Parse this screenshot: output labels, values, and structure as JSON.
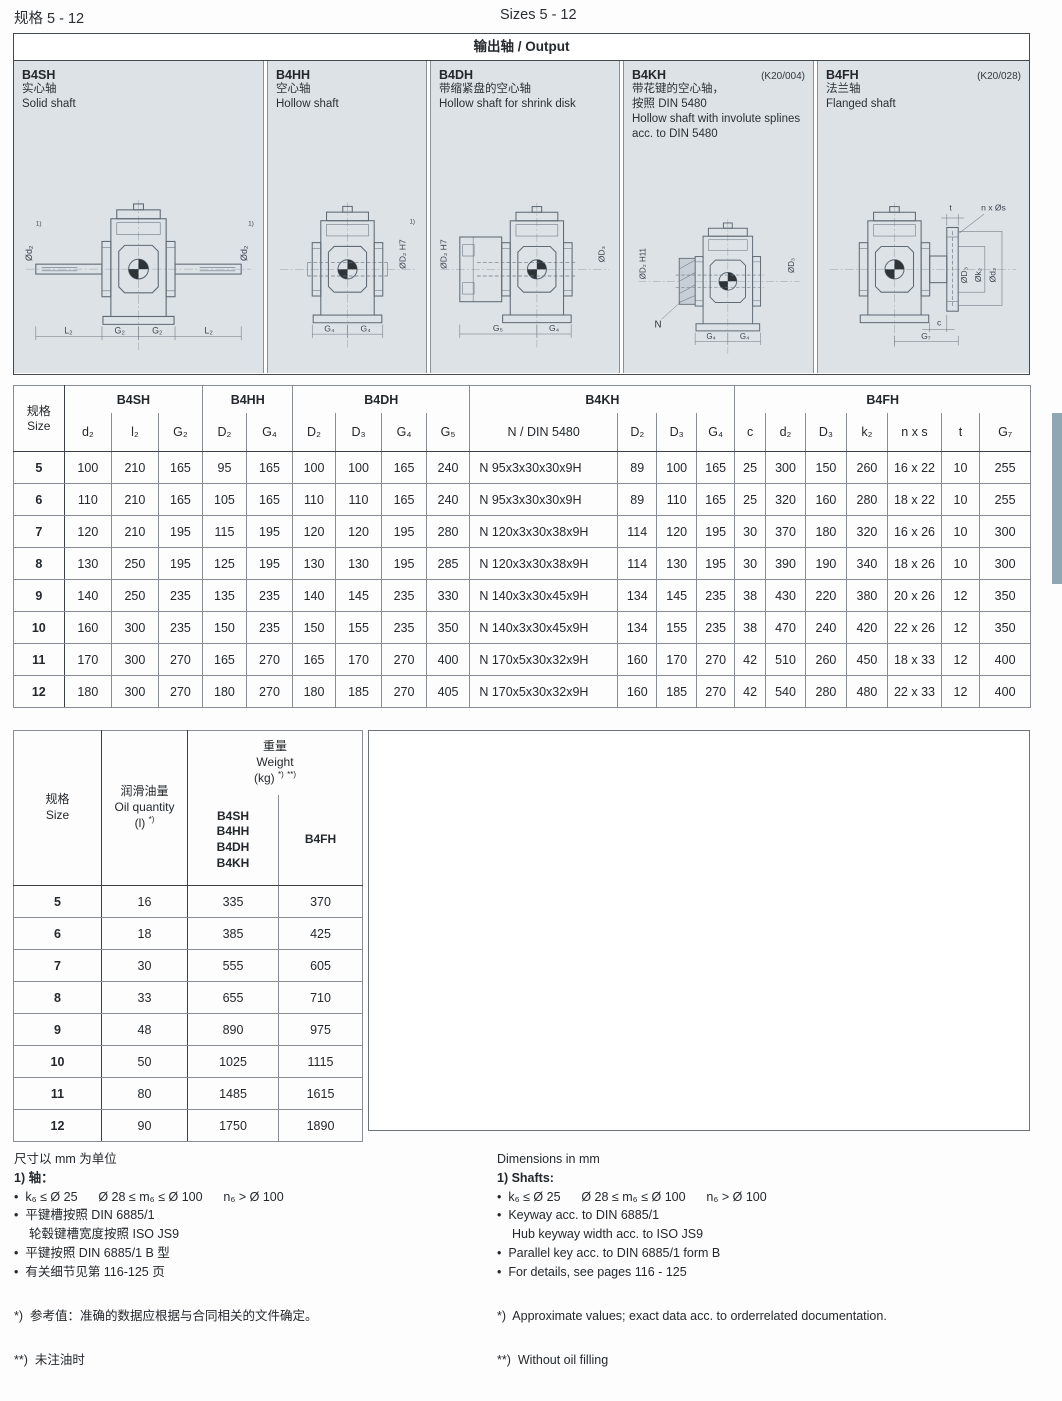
{
  "page": {
    "title_cn": "规格 5 - 12",
    "title_en": "Sizes 5 - 12"
  },
  "output_panel": {
    "title": "输出轴 / Output",
    "variants": [
      {
        "code": "B4SH",
        "ref": "",
        "name_cn": "实心轴",
        "name_cn2": "",
        "name_en": "Solid shaft"
      },
      {
        "code": "B4HH",
        "ref": "",
        "name_cn": "空心轴",
        "name_cn2": "",
        "name_en": "Hollow shaft"
      },
      {
        "code": "B4DH",
        "ref": "",
        "name_cn": "带缩紧盘的空心轴",
        "name_cn2": "",
        "name_en": "Hollow shaft for shrink disk"
      },
      {
        "code": "B4KH",
        "ref": "(K20/004)",
        "name_cn": "带花键的空心轴，",
        "name_cn2": "按照 DIN 5480",
        "name_en": "Hollow shaft with involute splines acc. to DIN 5480"
      },
      {
        "code": "B4FH",
        "ref": "(K20/028)",
        "name_cn": "法兰轴",
        "name_cn2": "",
        "name_en": "Flanged shaft"
      }
    ]
  },
  "drawings": {
    "b4sh": {
      "dia_left": "Ød₂",
      "fn_left": "1)",
      "dia_right": "Ød₂",
      "fn_right": "1)",
      "dim1": "L₂",
      "dim2": "G₂",
      "dim3": "G₂",
      "dim4": "L₂"
    },
    "b4hh": {
      "dia_right": "ØD₂ H7",
      "fn_right": "1)",
      "dim1": "G₄",
      "dim2": "G₄"
    },
    "b4dh": {
      "dia_left": "ØD₂ H7",
      "dia_right": "ØD₃",
      "dim1": "G₅",
      "dim2": "G₄"
    },
    "b4kh": {
      "dia_left": "ØD₂ H11",
      "dia_right": "ØD₃",
      "n_label": "N",
      "dim1": "G₄",
      "dim2": "G₄"
    },
    "b4fh": {
      "t_label": "t",
      "ns_label": "n x Øs",
      "dia1": "ØD₃",
      "dia2": "Øk₂",
      "dia3": "Ød₂",
      "c_label": "c",
      "dim1": "G₇"
    }
  },
  "dim_table": {
    "size_cn": "规格",
    "size_en": "Size",
    "groups": [
      {
        "label": "B4SH",
        "cols": [
          "d₂",
          "l₂",
          "G₂"
        ]
      },
      {
        "label": "B4HH",
        "cols": [
          "D₂",
          "G₄"
        ]
      },
      {
        "label": "B4DH",
        "cols": [
          "D₂",
          "D₃",
          "G₄",
          "G₅"
        ]
      },
      {
        "label": "B4KH",
        "cols": [
          "N / DIN 5480",
          "D₂",
          "D₃",
          "G₄"
        ]
      },
      {
        "label": "B4FH",
        "cols": [
          "c",
          "d₂",
          "D₃",
          "k₂",
          "n x s",
          "t",
          "G₇"
        ]
      }
    ],
    "rows": [
      {
        "size": "5",
        "cells": [
          "100",
          "210",
          "165",
          "95",
          "165",
          "100",
          "100",
          "165",
          "240",
          "N 95x3x30x30x9H",
          "89",
          "100",
          "165",
          "25",
          "300",
          "150",
          "260",
          "16 x 22",
          "10",
          "255"
        ]
      },
      {
        "size": "6",
        "cells": [
          "110",
          "210",
          "165",
          "105",
          "165",
          "110",
          "110",
          "165",
          "240",
          "N 95x3x30x30x9H",
          "89",
          "110",
          "165",
          "25",
          "320",
          "160",
          "280",
          "18 x 22",
          "10",
          "255"
        ]
      },
      {
        "size": "7",
        "cells": [
          "120",
          "210",
          "195",
          "115",
          "195",
          "120",
          "120",
          "195",
          "280",
          "N 120x3x30x38x9H",
          "114",
          "120",
          "195",
          "30",
          "370",
          "180",
          "320",
          "16 x 26",
          "10",
          "300"
        ]
      },
      {
        "size": "8",
        "cells": [
          "130",
          "250",
          "195",
          "125",
          "195",
          "130",
          "130",
          "195",
          "285",
          "N 120x3x30x38x9H",
          "114",
          "130",
          "195",
          "30",
          "390",
          "190",
          "340",
          "18 x 26",
          "10",
          "300"
        ]
      },
      {
        "size": "9",
        "cells": [
          "140",
          "250",
          "235",
          "135",
          "235",
          "140",
          "145",
          "235",
          "330",
          "N 140x3x30x45x9H",
          "134",
          "145",
          "235",
          "38",
          "430",
          "220",
          "380",
          "20 x 26",
          "12",
          "350"
        ]
      },
      {
        "size": "10",
        "cells": [
          "160",
          "300",
          "235",
          "150",
          "235",
          "150",
          "155",
          "235",
          "350",
          "N 140x3x30x45x9H",
          "134",
          "155",
          "235",
          "38",
          "470",
          "240",
          "420",
          "22 x 26",
          "12",
          "350"
        ]
      },
      {
        "size": "11",
        "cells": [
          "170",
          "300",
          "270",
          "165",
          "270",
          "165",
          "170",
          "270",
          "400",
          "N 170x5x30x32x9H",
          "160",
          "170",
          "270",
          "42",
          "510",
          "260",
          "450",
          "18 x 33",
          "12",
          "400"
        ]
      },
      {
        "size": "12",
        "cells": [
          "180",
          "300",
          "270",
          "180",
          "270",
          "180",
          "185",
          "270",
          "405",
          "N 170x5x30x32x9H",
          "160",
          "185",
          "270",
          "42",
          "540",
          "280",
          "480",
          "22 x 33",
          "12",
          "400"
        ]
      }
    ]
  },
  "weight_table": {
    "size_cn": "规格",
    "size_en": "Size",
    "oil_cn": "润滑油量",
    "oil_en": "Oil quantity",
    "oil_unit": "(l)",
    "oil_sup": "*)",
    "wt_cn": "重量",
    "wt_en": "Weight",
    "wt_unit": "(kg)",
    "wt_sup1": "*)",
    "wt_sup2": "**)",
    "col_a": [
      "B4SH",
      "B4HH",
      "B4DH",
      "B4KH"
    ],
    "col_b": "B4FH",
    "rows": [
      [
        "5",
        "16",
        "335",
        "370"
      ],
      [
        "6",
        "18",
        "385",
        "425"
      ],
      [
        "7",
        "30",
        "555",
        "605"
      ],
      [
        "8",
        "33",
        "655",
        "710"
      ],
      [
        "9",
        "48",
        "890",
        "975"
      ],
      [
        "10",
        "50",
        "1025",
        "1115"
      ],
      [
        "11",
        "80",
        "1485",
        "1615"
      ],
      [
        "12",
        "90",
        "1750",
        "1890"
      ]
    ]
  },
  "notes_cn": {
    "units": "尺寸以 mm 为单位",
    "head": "1) 轴：",
    "line1": "•  k₆ ≤ Ø 25      Ø 28 ≤ m₆ ≤ Ø 100      n₆ > Ø 100",
    "line2": "•  平键槽按照 DIN 6885/1",
    "line2b": "轮毂键槽宽度按照 ISO JS9",
    "line3": "•  平键按照 DIN 6885/1 B 型",
    "line4": "•  有关细节见第 116-125 页",
    "star": "*)  参考值：准确的数据应根据与合同相关的文件确定。",
    "dstar": "**)  未注油时"
  },
  "notes_en": {
    "units": "Dimensions in mm",
    "head": "1) Shafts:",
    "line1": "•  k₆ ≤ Ø 25      Ø 28 ≤ m₆ ≤ Ø 100      n₆ > Ø 100",
    "line2": "•  Keyway acc. to DIN 6885/1",
    "line2b": "Hub keyway width acc. to ISO JS9",
    "line3": "•  Parallel key acc. to DIN 6885/1 form B",
    "line4": "•  For details, see pages 116 - 125",
    "star": "*)  Approximate values; exact data acc. to orderrelated documentation.",
    "dstar": "**)  Without oil filling"
  }
}
